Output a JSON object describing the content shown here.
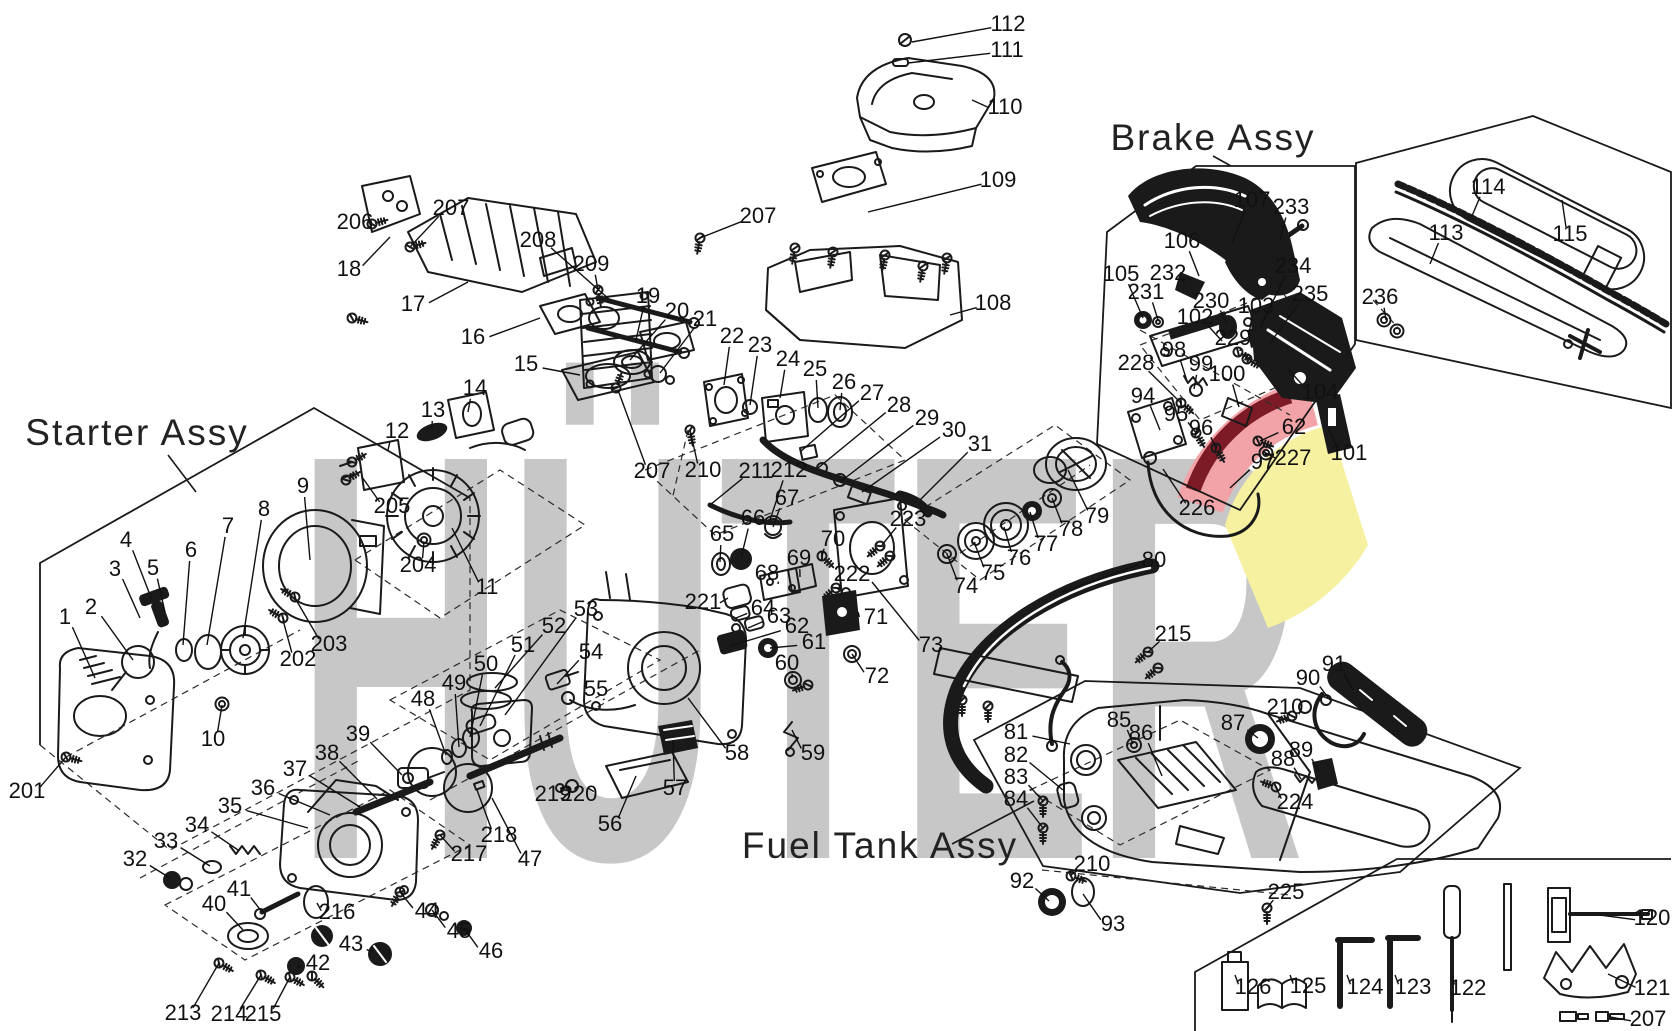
{
  "canvas": {
    "width": 1672,
    "height": 1031,
    "background": "#ffffff",
    "ink": "#1a1a1a"
  },
  "watermark": {
    "text": "HÜTER",
    "color": "#c7c7c7",
    "accent_pink": "#f2a3a8",
    "accent_dark_red": "#7c1b26",
    "accent_yellow": "#f6f1a1"
  },
  "assemblies": [
    {
      "id": "starter",
      "label": "Starter Assy"
    },
    {
      "id": "brake",
      "label": "Brake Assy"
    },
    {
      "id": "fuel",
      "label": "Fuel Tank Assy"
    }
  ],
  "callouts": [
    [
      "112",
      1008,
      23,
      912,
      42
    ],
    [
      "111",
      1007,
      49,
      908,
      63
    ],
    [
      "110",
      1005,
      106,
      972,
      100
    ],
    [
      "109",
      998,
      179,
      868,
      212
    ],
    [
      "108",
      993,
      302,
      950,
      315
    ],
    [
      "207",
      758,
      215,
      700,
      238
    ],
    [
      "206",
      355,
      221,
      372,
      224
    ],
    [
      "207",
      451,
      207,
      410,
      247
    ],
    [
      "18",
      349,
      268,
      390,
      237
    ],
    [
      "17",
      413,
      303,
      468,
      282
    ],
    [
      "16",
      473,
      336,
      540,
      318
    ],
    [
      "208",
      538,
      239,
      610,
      300
    ],
    [
      "209",
      591,
      263,
      598,
      290
    ],
    [
      "15",
      526,
      363,
      580,
      375
    ],
    [
      "14",
      475,
      387,
      468,
      412
    ],
    [
      "13",
      433,
      409,
      432,
      430
    ],
    [
      "12",
      397,
      430,
      388,
      450
    ],
    [
      "19",
      648,
      295,
      636,
      340
    ],
    [
      "20",
      677,
      310,
      630,
      360
    ],
    [
      "21",
      705,
      318,
      660,
      373
    ],
    [
      "22",
      732,
      335,
      724,
      385
    ],
    [
      "23",
      760,
      344,
      750,
      405
    ],
    [
      "24",
      788,
      358,
      780,
      398
    ],
    [
      "25",
      815,
      368,
      818,
      408
    ],
    [
      "26",
      844,
      381,
      840,
      410
    ],
    [
      "27",
      872,
      392,
      800,
      452
    ],
    [
      "28",
      899,
      404,
      818,
      468
    ],
    [
      "29",
      927,
      417,
      840,
      482
    ],
    [
      "30",
      954,
      429,
      862,
      492
    ],
    [
      "31",
      980,
      443,
      920,
      500
    ],
    [
      "211",
      756,
      470,
      710,
      505
    ],
    [
      "212",
      789,
      469,
      770,
      520
    ],
    [
      "207",
      652,
      470,
      618,
      390
    ],
    [
      "210",
      703,
      469,
      690,
      430
    ],
    [
      "205",
      392,
      505,
      362,
      477
    ],
    [
      "204",
      418,
      564,
      424,
      542
    ],
    [
      "11",
      487,
      586,
      452,
      528
    ],
    [
      "203",
      329,
      643,
      295,
      598
    ],
    [
      "202",
      298,
      658,
      283,
      620
    ],
    [
      "201",
      27,
      790,
      66,
      757
    ],
    [
      "1",
      65,
      616,
      95,
      678
    ],
    [
      "2",
      91,
      606,
      133,
      660
    ],
    [
      "3",
      115,
      568,
      140,
      618
    ],
    [
      "4",
      126,
      539,
      152,
      600
    ],
    [
      "5",
      153,
      567,
      165,
      612
    ],
    [
      "6",
      191,
      549,
      183,
      645
    ],
    [
      "7",
      228,
      525,
      207,
      645
    ],
    [
      "8",
      264,
      508,
      243,
      638
    ],
    [
      "9",
      303,
      485,
      310,
      560
    ],
    [
      "10",
      213,
      738,
      222,
      705
    ],
    [
      "32",
      135,
      858,
      170,
      878
    ],
    [
      "33",
      166,
      840,
      210,
      866
    ],
    [
      "34",
      197,
      824,
      238,
      850
    ],
    [
      "35",
      230,
      805,
      308,
      828
    ],
    [
      "36",
      263,
      787,
      330,
      815
    ],
    [
      "37",
      295,
      768,
      360,
      807
    ],
    [
      "38",
      327,
      752,
      377,
      799
    ],
    [
      "39",
      358,
      733,
      402,
      775
    ],
    [
      "40",
      214,
      903,
      243,
      930
    ],
    [
      "41",
      239,
      888,
      262,
      912
    ],
    [
      "42",
      318,
      962,
      297,
      967
    ],
    [
      "43",
      351,
      943,
      372,
      952
    ],
    [
      "44",
      427,
      910,
      400,
      892
    ],
    [
      "45",
      459,
      930,
      432,
      910
    ],
    [
      "46",
      491,
      950,
      464,
      928
    ],
    [
      "213",
      183,
      1012,
      219,
      963
    ],
    [
      "214",
      229,
      1013,
      261,
      975
    ],
    [
      "215",
      263,
      1013,
      290,
      977
    ],
    [
      "216",
      337,
      911,
      317,
      903
    ],
    [
      "217",
      469,
      853,
      440,
      835
    ],
    [
      "47",
      530,
      858,
      492,
      798
    ],
    [
      "48",
      423,
      698,
      446,
      755
    ],
    [
      "49",
      454,
      682,
      459,
      747
    ],
    [
      "50",
      486,
      663,
      470,
      737
    ],
    [
      "51",
      523,
      644,
      480,
      726
    ],
    [
      "52",
      554,
      625,
      495,
      688
    ],
    [
      "53",
      586,
      608,
      505,
      715
    ],
    [
      "54",
      591,
      651,
      557,
      684
    ],
    [
      "55",
      596,
      688,
      603,
      700
    ],
    [
      "56",
      610,
      823,
      636,
      776
    ],
    [
      "57",
      675,
      787,
      673,
      740
    ],
    [
      "58",
      737,
      752,
      688,
      698
    ],
    [
      "218",
      499,
      834,
      477,
      790
    ],
    [
      "219",
      553,
      793,
      560,
      788
    ],
    [
      "220",
      579,
      793,
      588,
      788
    ],
    [
      "221",
      703,
      601,
      728,
      598
    ],
    [
      "222",
      852,
      573,
      838,
      590
    ],
    [
      "223",
      908,
      518,
      882,
      545
    ],
    [
      "59",
      813,
      752,
      792,
      730
    ],
    [
      "60",
      787,
      662,
      792,
      678
    ],
    [
      "61",
      814,
      641,
      770,
      648
    ],
    [
      "62",
      797,
      625,
      730,
      646
    ],
    [
      "63",
      779,
      615,
      748,
      628
    ],
    [
      "64",
      763,
      607,
      736,
      618
    ],
    [
      "65",
      722,
      533,
      720,
      562
    ],
    [
      "66",
      753,
      517,
      741,
      558
    ],
    [
      "67",
      787,
      497,
      773,
      527
    ],
    [
      "68",
      767,
      572,
      778,
      584
    ],
    [
      "69",
      799,
      557,
      800,
      577
    ],
    [
      "70",
      833,
      538,
      822,
      556
    ],
    [
      "71",
      876,
      616,
      858,
      612
    ],
    [
      "72",
      877,
      675,
      852,
      654
    ],
    [
      "73",
      931,
      644,
      872,
      582
    ],
    [
      "74",
      966,
      585,
      947,
      554
    ],
    [
      "75",
      993,
      572,
      974,
      542
    ],
    [
      "76",
      1019,
      557,
      1004,
      527
    ],
    [
      "77",
      1046,
      543,
      1030,
      512
    ],
    [
      "78",
      1071,
      528,
      1052,
      498
    ],
    [
      "79",
      1097,
      515,
      1068,
      470
    ],
    [
      "80",
      1154,
      559,
      1062,
      592
    ],
    [
      "215",
      1173,
      633,
      1148,
      652
    ],
    [
      "94",
      1143,
      395,
      1160,
      430
    ],
    [
      "95",
      1176,
      413,
      1196,
      433
    ],
    [
      "96",
      1201,
      427,
      1216,
      448
    ],
    [
      "97",
      1263,
      461,
      1230,
      488
    ],
    [
      "98",
      1174,
      349,
      1187,
      381
    ],
    [
      "99",
      1201,
      363,
      1194,
      389
    ],
    [
      "100",
      1227,
      373,
      1239,
      407
    ],
    [
      "101",
      1349,
      452,
      1328,
      428
    ],
    [
      "102",
      1195,
      316,
      1222,
      341
    ],
    [
      "103",
      1256,
      305,
      1249,
      334
    ],
    [
      "104",
      1320,
      391,
      1288,
      369
    ],
    [
      "105",
      1121,
      273,
      1143,
      318
    ],
    [
      "106",
      1182,
      240,
      1199,
      276
    ],
    [
      "107",
      1252,
      199,
      1232,
      243
    ],
    [
      "226",
      1197,
      507,
      1163,
      469
    ],
    [
      "227",
      1293,
      457,
      1264,
      452
    ],
    [
      "228",
      1136,
      362,
      1181,
      403
    ],
    [
      "229",
      1233,
      337,
      1240,
      351
    ],
    [
      "230",
      1211,
      300,
      1227,
      324
    ],
    [
      "231",
      1146,
      291,
      1158,
      320
    ],
    [
      "232",
      1168,
      272,
      1185,
      283
    ],
    [
      "233",
      1291,
      206,
      1280,
      240
    ],
    [
      "234",
      1293,
      265,
      1260,
      328
    ],
    [
      "235",
      1310,
      293,
      1270,
      343
    ],
    [
      "62",
      1294,
      426,
      1260,
      441
    ],
    [
      "113",
      1446,
      232,
      1430,
      264
    ],
    [
      "114",
      1488,
      186,
      1472,
      216
    ],
    [
      "115",
      1570,
      233,
      1562,
      200
    ],
    [
      "236",
      1380,
      296,
      1386,
      320
    ],
    [
      "81",
      1016,
      731,
      1070,
      744
    ],
    [
      "82",
      1016,
      754,
      1063,
      790
    ],
    [
      "83",
      1016,
      776,
      1043,
      801
    ],
    [
      "84",
      1016,
      798,
      1043,
      828
    ],
    [
      "85",
      1119,
      719,
      1133,
      744
    ],
    [
      "86",
      1141,
      732,
      1162,
      776
    ],
    [
      "87",
      1233,
      722,
      1258,
      738
    ],
    [
      "88",
      1283,
      758,
      1301,
      779
    ],
    [
      "89",
      1301,
      749,
      1319,
      771
    ],
    [
      "90",
      1308,
      677,
      1330,
      700
    ],
    [
      "91",
      1334,
      663,
      1353,
      690
    ],
    [
      "92",
      1022,
      880,
      1049,
      901
    ],
    [
      "93",
      1113,
      923,
      1083,
      894
    ],
    [
      "210",
      1285,
      706,
      1299,
      714
    ],
    [
      "210",
      1092,
      863,
      1071,
      875
    ],
    [
      "224",
      1295,
      801,
      1276,
      787
    ],
    [
      "225",
      1286,
      891,
      1267,
      908
    ],
    [
      "120",
      1652,
      917,
      1600,
      915
    ],
    [
      "121",
      1652,
      987,
      1608,
      974
    ],
    [
      "122",
      1468,
      987,
      1452,
      975
    ],
    [
      "123",
      1413,
      986,
      1395,
      975
    ],
    [
      "124",
      1365,
      986,
      1347,
      975
    ],
    [
      "125",
      1308,
      985,
      1290,
      975
    ],
    [
      "126",
      1253,
      986,
      1235,
      975
    ],
    [
      "207",
      1648,
      1018,
      1610,
      1017
    ]
  ]
}
